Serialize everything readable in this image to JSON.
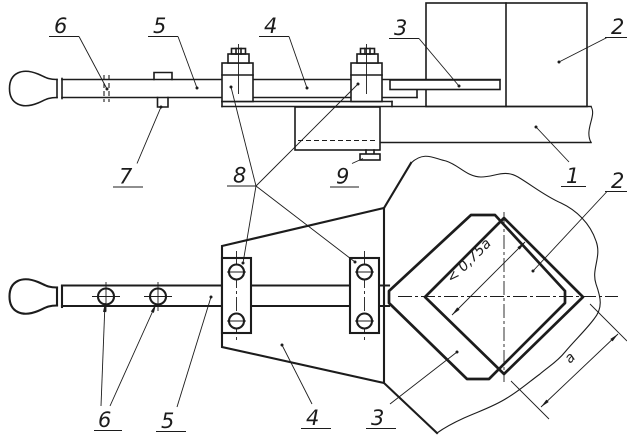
{
  "figure": {
    "callouts": {
      "n1": "1",
      "n2": "2",
      "n3": "3",
      "n4": "4",
      "n5": "5",
      "n6": "6",
      "n7": "7",
      "n8": "8",
      "n9": "9"
    },
    "dimensions": {
      "hole_width": "< 0,75a",
      "plate_edge": "a"
    },
    "colors": {
      "ink": "#1c1c1c",
      "paper": "#ffffff"
    }
  }
}
